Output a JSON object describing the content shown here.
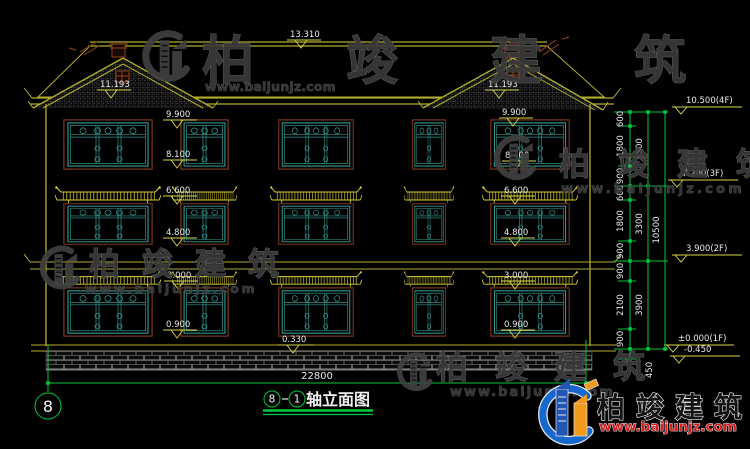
{
  "drawing": {
    "axis_left_bubble": "8",
    "title_axis_start": "8",
    "title_axis_end": "1",
    "title": "轴立面图"
  },
  "elevations": {
    "ridge": "13.310",
    "gable": "11.193",
    "eave": "9.900",
    "win3_top": "8.100",
    "canopy2": "6.600",
    "sill2": "4.800",
    "canopy1": "3.000",
    "sill1": "0.900",
    "plinth": "0.330",
    "f4": "10.500(4F)",
    "f3": "7.200(3F)",
    "f2": "3.900(2F)",
    "f1": "±0.000(1F)",
    "ground": "-0.450"
  },
  "dims": {
    "chain": [
      "600",
      "1800",
      "900",
      "600",
      "1800",
      "900",
      "900",
      "2100",
      "900"
    ],
    "subtotals": [
      "3300",
      "3300",
      "3900"
    ],
    "total": "10500",
    "below": "450",
    "width": "22800"
  },
  "watermark": {
    "brand": "柏竣建筑",
    "url": "www.baijunjz.com"
  },
  "brand": {
    "name": "柏竣建筑",
    "url": "www.baijunjz.com"
  }
}
